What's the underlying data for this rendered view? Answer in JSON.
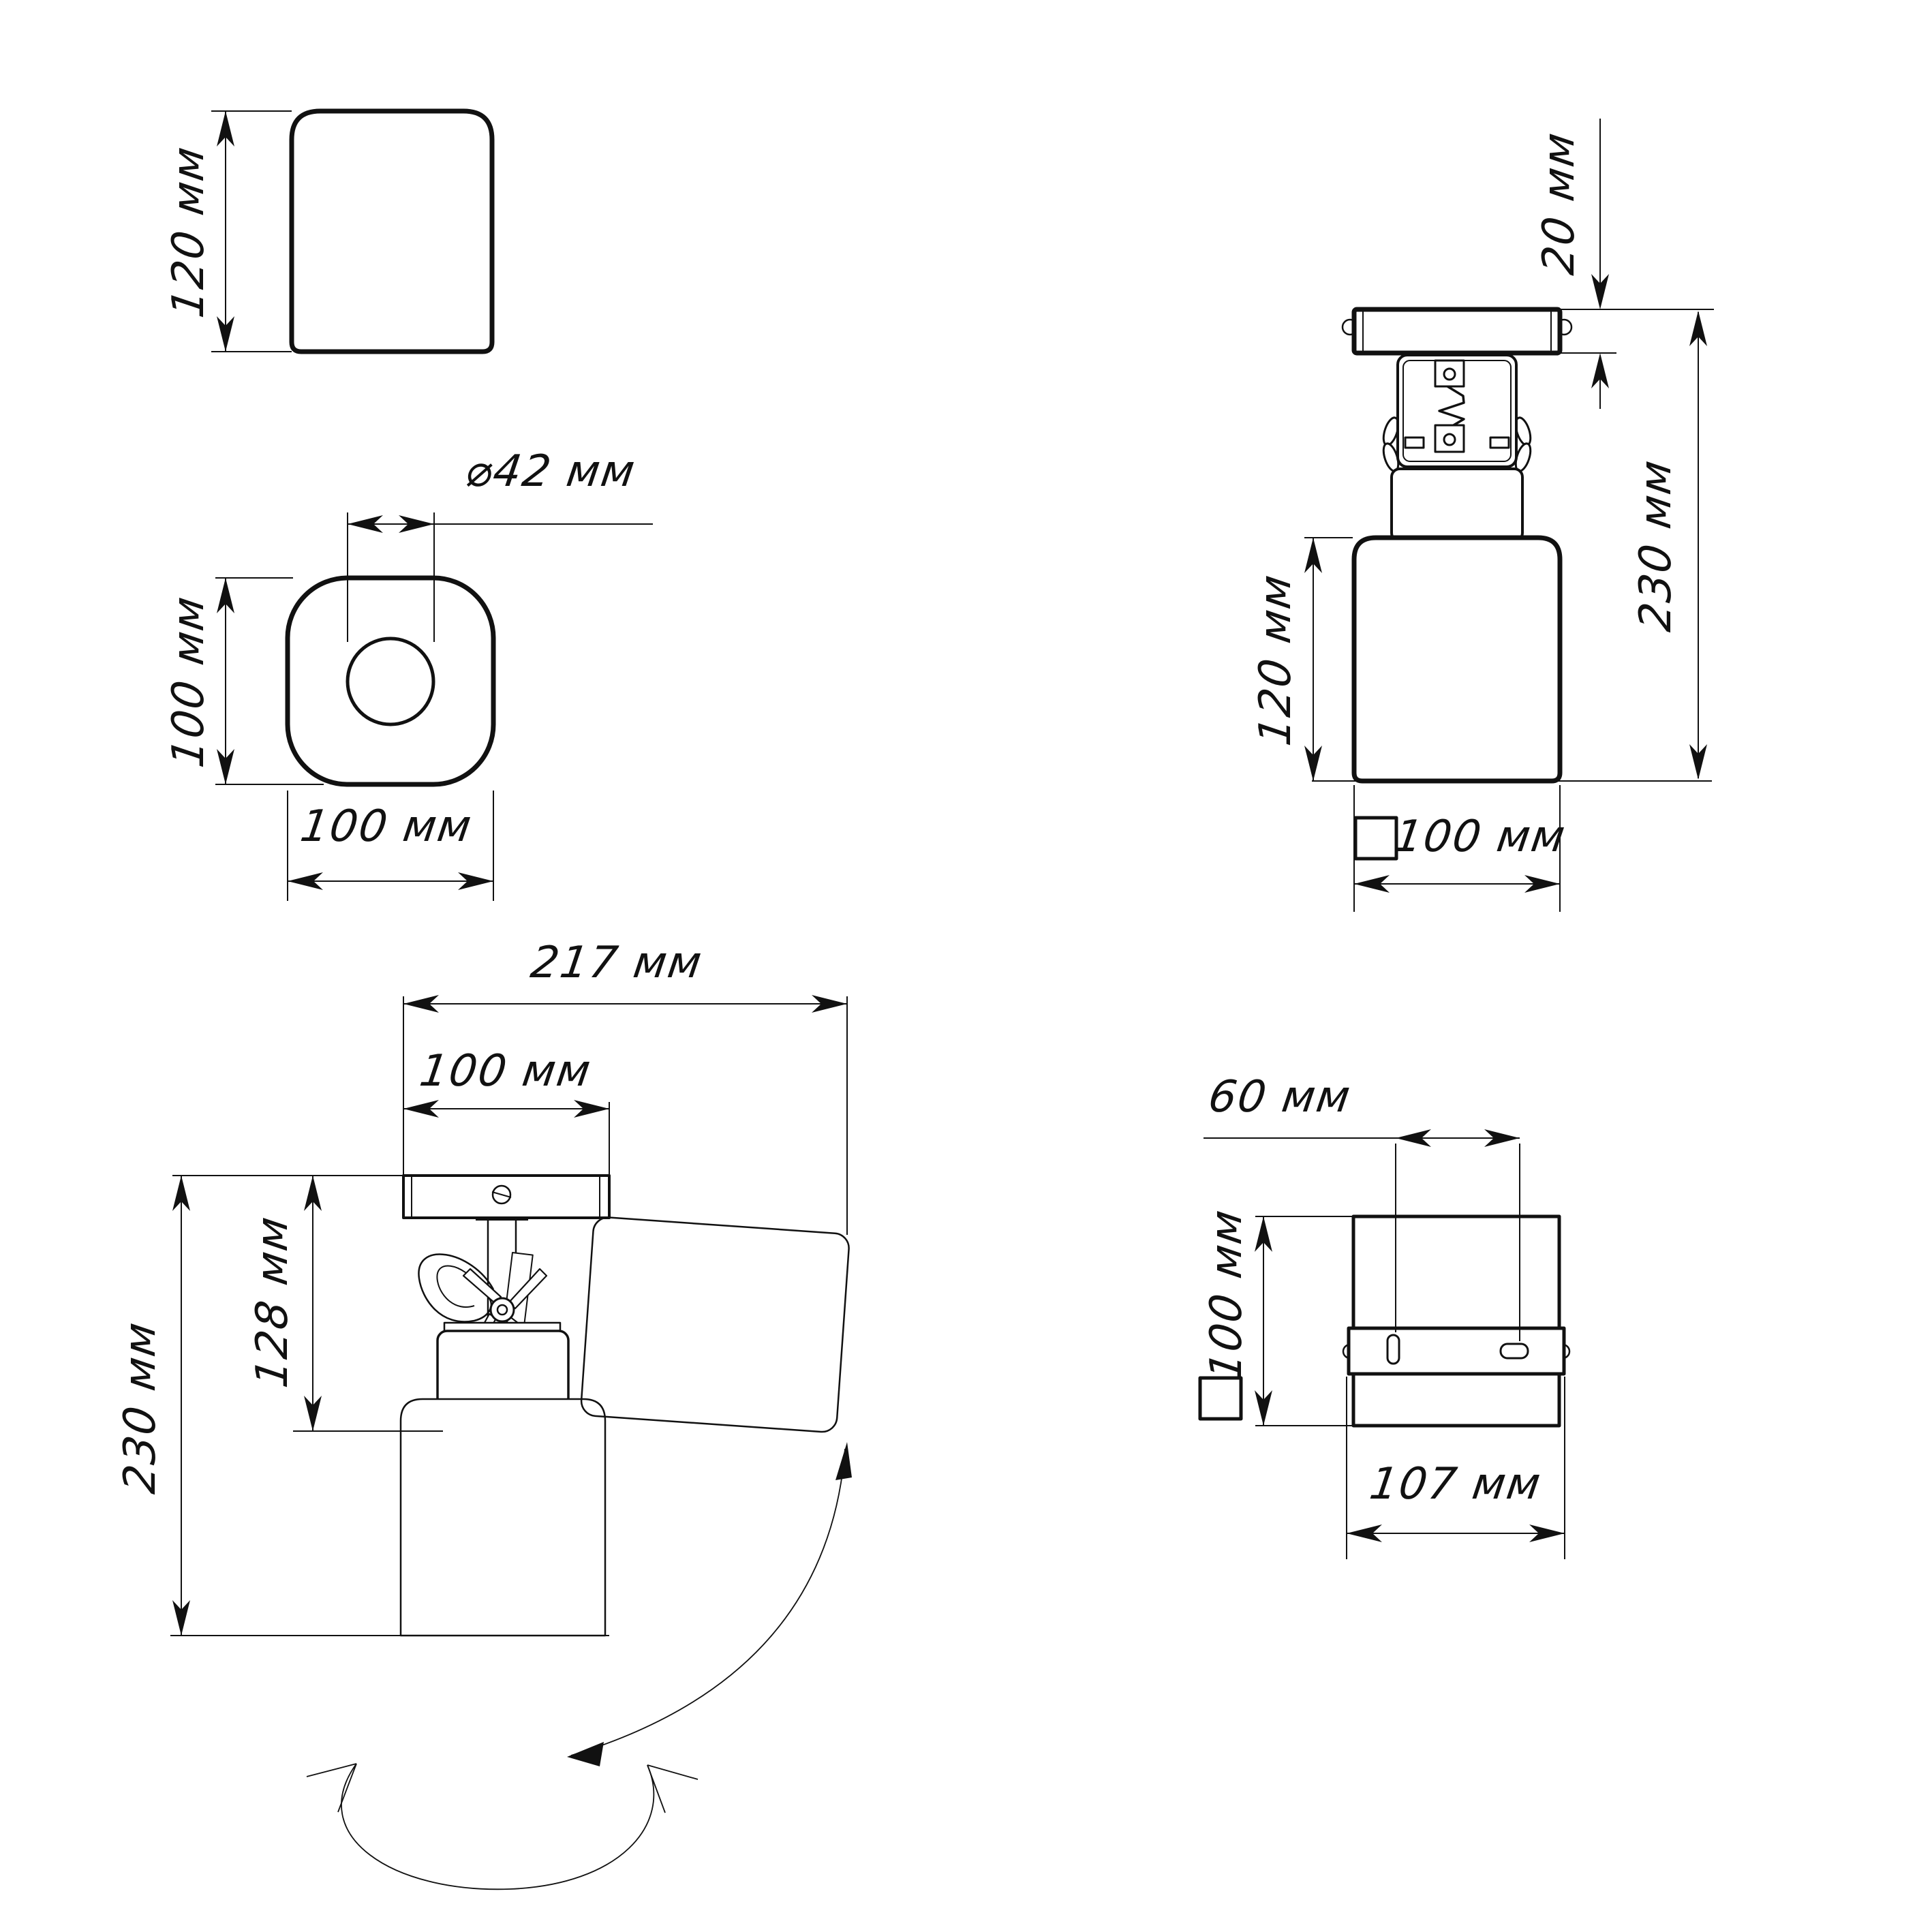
{
  "drawing": {
    "type": "technical-dimension-drawing",
    "product": "adjustable spot light fixture",
    "units": "мм",
    "views": {
      "shade_side": {
        "height": "120 мм"
      },
      "shade_top": {
        "hole_diameter": "⌀42 мм",
        "depth": "100 мм",
        "width": "100 мм"
      },
      "front": {
        "canopy_height": "20 мм",
        "total_height": "230 мм",
        "shade_height": "120 мм",
        "shade_width": "100 мм"
      },
      "side_tilted": {
        "max_span": "217 мм",
        "canopy_width": "100 мм",
        "bracket_height": "128 мм",
        "total_height": "230 мм"
      },
      "back": {
        "hole_spacing": "60 мм",
        "body_height": "100 мм",
        "body_width": "107 мм"
      }
    },
    "line_color": "#111111"
  }
}
